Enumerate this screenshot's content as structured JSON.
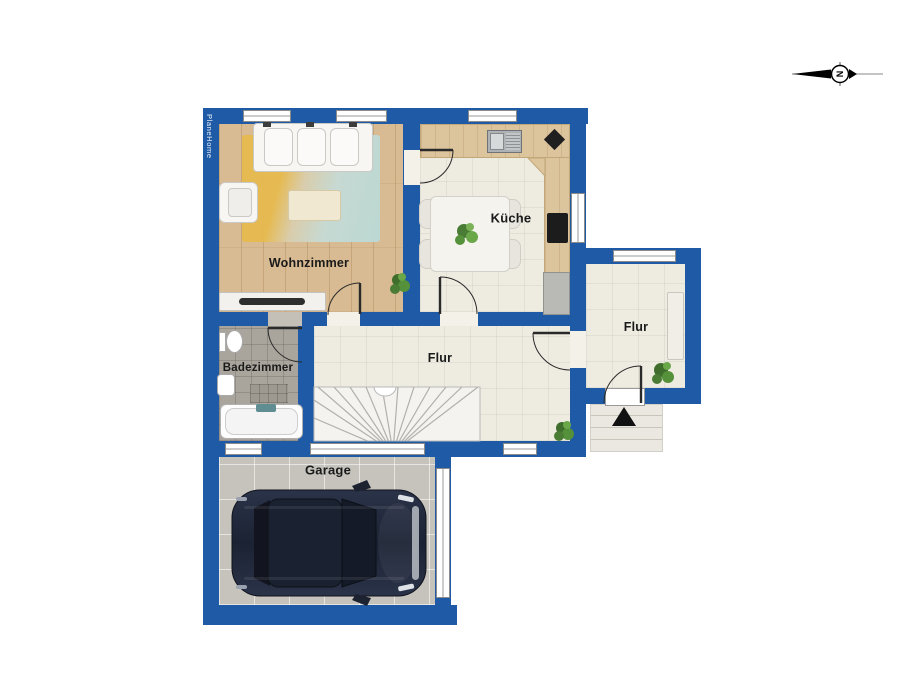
{
  "brand": "PlaneHome",
  "compass": {
    "label": "N"
  },
  "rooms": [
    {
      "label": "Wohnzimmer"
    },
    {
      "label": "Küche"
    },
    {
      "label": "Badezimmer"
    },
    {
      "label": "Flur"
    },
    {
      "label": "Flur"
    },
    {
      "label": "Garage"
    }
  ],
  "colors": {
    "wall": "#1e5aa5",
    "wood_floor": "#d8bb92",
    "tile_floor": "#eeebe0",
    "bath_floor": "#a9a59d",
    "garage_floor": "#c6c3bc",
    "rug_yellow": "#e7ba4e",
    "rug_blue": "#badbd8",
    "car_body": "#232a3a",
    "plant_green": "#4e8738"
  }
}
